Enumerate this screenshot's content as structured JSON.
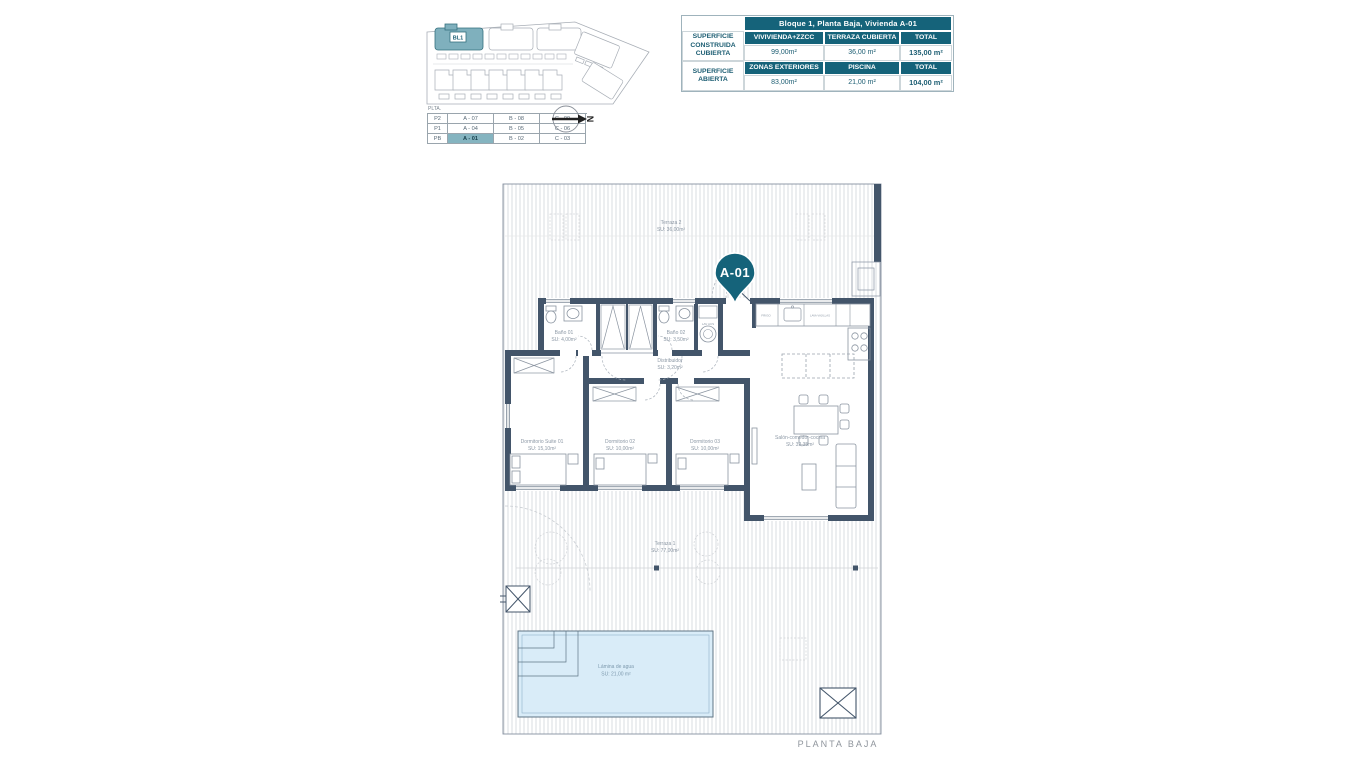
{
  "header_table": {
    "title": "Bloque 1, Planta Baja, Vivienda A-01",
    "rows": [
      {
        "label": "SUPERFICIE CONSTRUIDA CUBIERTA",
        "cols": [
          "VIVIVIENDA+ZZCC",
          "TERRAZA CUBIERTA",
          "TOTAL"
        ],
        "values": [
          "99,00m²",
          "36,00 m²",
          "135,00 m²"
        ]
      },
      {
        "label": "SUPERFICIE ABIERTA",
        "cols": [
          "ZONAS EXTERIORES",
          "PISCINA",
          "TOTAL"
        ],
        "values": [
          "83,00m²",
          "21,00 m²",
          "104,00 m²"
        ]
      }
    ]
  },
  "site_plan": {
    "block_label": "BL1",
    "north_label": "N",
    "levels_table": {
      "caption": "PLTA.",
      "rows": [
        {
          "level": "P2",
          "units": [
            "A - 07",
            "B - 08",
            "C - 09"
          ]
        },
        {
          "level": "P1",
          "units": [
            "A - 04",
            "B - 05",
            "C - 06"
          ]
        },
        {
          "level": "PB",
          "units": [
            "A - 01",
            "B - 02",
            "C - 03"
          ]
        }
      ],
      "highlighted_unit": "A - 01"
    }
  },
  "floor_plan": {
    "pin_label": "A-01",
    "caption": "PLANTA BAJA",
    "rooms": {
      "terraza2": {
        "name": "Terraza 2",
        "area": "SU: 36,00m²"
      },
      "bano1": {
        "name": "Baño 01",
        "area": "SU: 4,00m²"
      },
      "bano2": {
        "name": "Baño 02",
        "area": "SU: 3,50m²"
      },
      "distribuidor": {
        "name": "Distribuidor",
        "area": "SU: 3,20m²"
      },
      "suite": {
        "name": "Dormitorio Suite 01",
        "area": "SU: 15,10m²"
      },
      "dorm2": {
        "name": "Dormitorio 02",
        "area": "SU: 10,00m²"
      },
      "dorm3": {
        "name": "Dormitorio 03",
        "area": "SU: 10,00m²"
      },
      "salon": {
        "name": "Salón-comedor-cocina",
        "area": "SU: 32,35m²"
      },
      "terraza1": {
        "name": "Terraza 1",
        "area": "SU: 77,00m²"
      },
      "piscina": {
        "name": "Lámina de agua",
        "area": "SU: 21,00 m²"
      }
    },
    "fixtures": {
      "fridge": "FRIGO",
      "dishwasher": "LAVA VAJILLAS",
      "laundry": "LAV ACS"
    }
  },
  "colors": {
    "teal": "#15637a",
    "wall": "#43556a",
    "highlight": "#85b4c0",
    "pool": "#d9ecf8"
  }
}
